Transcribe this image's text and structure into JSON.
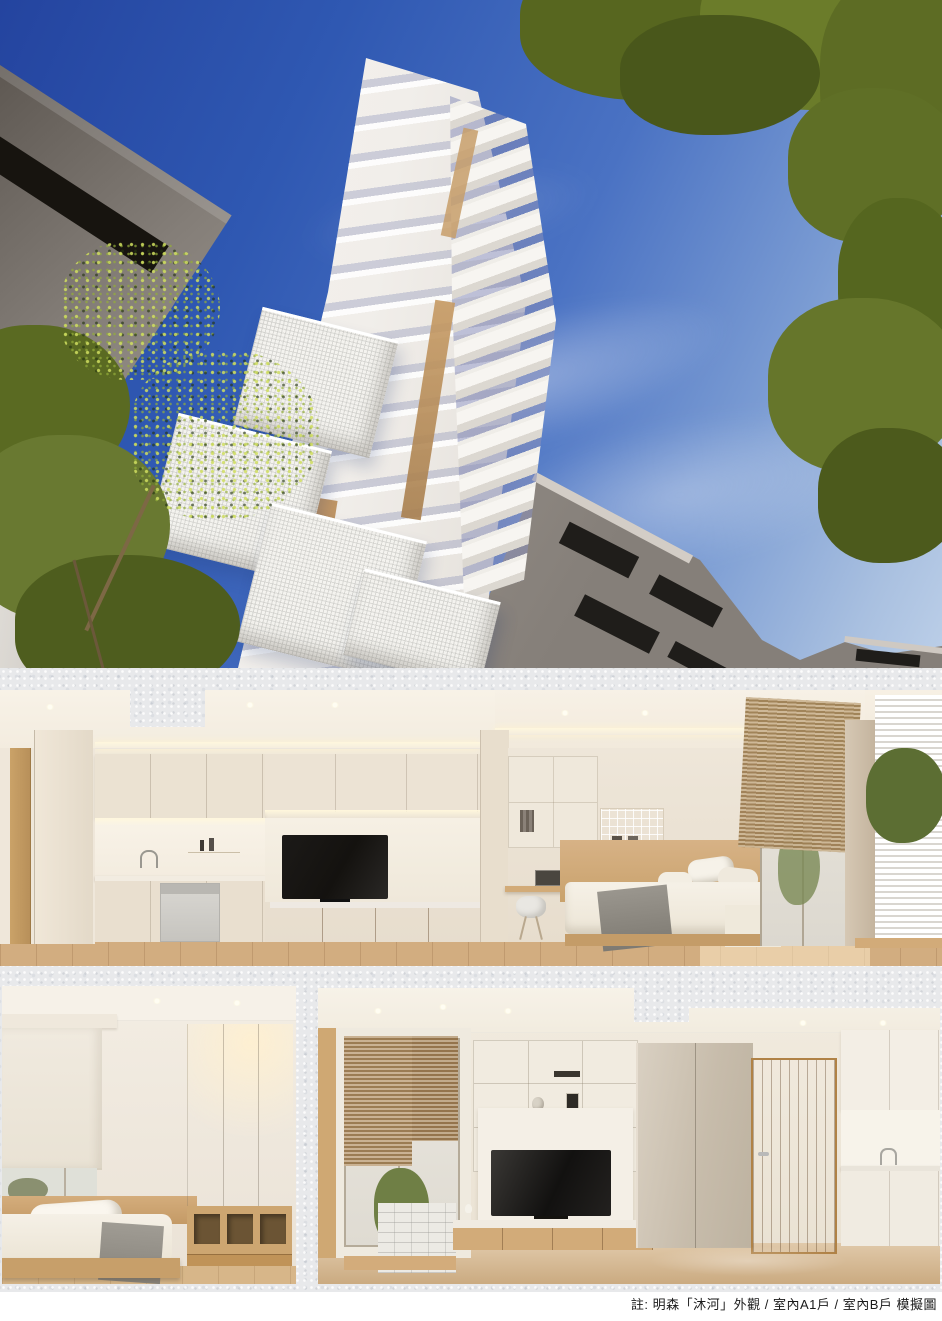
{
  "caption": {
    "text": "註: 明森「沐河」外觀 / 室內A1戶 / 室內B戶 模擬圖"
  },
  "photos": {
    "exterior": {
      "label": "明森「沐河」外觀"
    },
    "interior_a1": {
      "label": "室內A1戶"
    },
    "interior_b_bedroom": {
      "label": "室內B戶"
    },
    "interior_b_living": {
      "label": "室內B戶"
    }
  },
  "colors": {
    "page-bg": "#ffffff",
    "paper": "#e8e9eb",
    "sky-top": "#24449f",
    "sky-bottom": "#bccfe8",
    "tower-white": "#f7f5f1",
    "building-gray": "#857f79",
    "leaf-green": "#5d7026",
    "leaf-highlight": "#c3cf4e",
    "wood": "#c9a373",
    "wall-cream": "#ece3d5",
    "tv-black": "#14120f",
    "caption-text": "#1a1a1a"
  }
}
